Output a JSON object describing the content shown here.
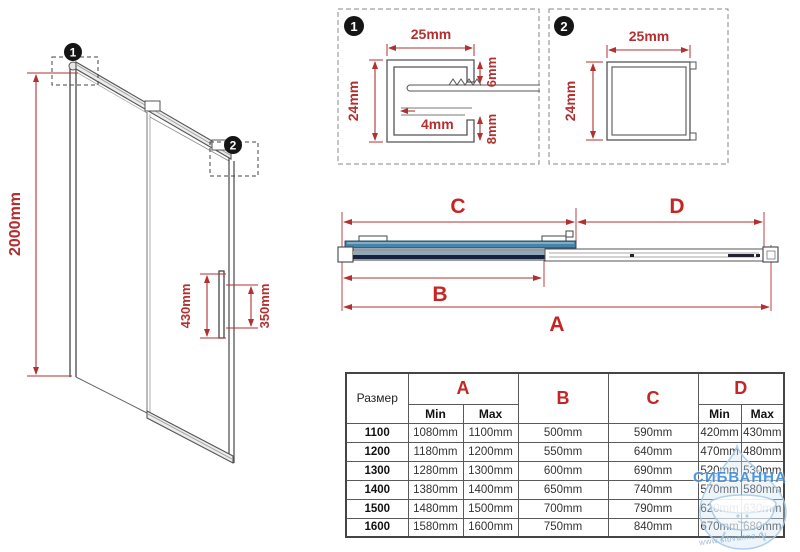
{
  "colors": {
    "dimension_red": "#b23030",
    "header_red": "#c42525",
    "glass_blue": "#4585ac",
    "profile_navy": "#16233f",
    "line_gray": "#555555",
    "watermark_blue": "#3f8cd6",
    "watermark_light": "#a9cae6"
  },
  "left_view": {
    "height_dim": "2000mm",
    "handle_dim_left": "430mm",
    "handle_dim_right": "350mm",
    "marker1": "1",
    "marker2": "2"
  },
  "detail1": {
    "badge": "1",
    "width_dim": "25mm",
    "height_dim": "24mm",
    "inner_dim": "4mm",
    "upper_dim": "6mm",
    "lower_dim": "8mm"
  },
  "detail2": {
    "badge": "2",
    "width_dim": "25mm",
    "height_dim": "24mm"
  },
  "section": {
    "dim_a": "A",
    "dim_b": "B",
    "dim_c": "C",
    "dim_d": "D"
  },
  "table": {
    "size_header": "Размер",
    "col_a": "A",
    "col_b": "B",
    "col_c": "C",
    "col_d": "D",
    "min": "Min",
    "max": "Max",
    "rows": [
      {
        "size": "1100",
        "a_min": "1080mm",
        "a_max": "1100mm",
        "b": "500mm",
        "c": "590mm",
        "d_min": "420mm",
        "d_max": "430mm"
      },
      {
        "size": "1200",
        "a_min": "1180mm",
        "a_max": "1200mm",
        "b": "550mm",
        "c": "640mm",
        "d_min": "470mm",
        "d_max": "480mm"
      },
      {
        "size": "1300",
        "a_min": "1280mm",
        "a_max": "1300mm",
        "b": "600mm",
        "c": "690mm",
        "d_min": "520mm",
        "d_max": "530mm"
      },
      {
        "size": "1400",
        "a_min": "1380mm",
        "a_max": "1400mm",
        "b": "650mm",
        "c": "740mm",
        "d_min": "570mm",
        "d_max": "580mm"
      },
      {
        "size": "1500",
        "a_min": "1480mm",
        "a_max": "1500mm",
        "b": "700mm",
        "c": "790mm",
        "d_min": "620mm",
        "d_max": "630mm"
      },
      {
        "size": "1600",
        "a_min": "1580mm",
        "a_max": "1600mm",
        "b": "750mm",
        "c": "840mm",
        "d_min": "670mm",
        "d_max": "680mm"
      }
    ]
  },
  "watermark": {
    "name": "СИБВАННА",
    "site": "www.sibvanna.ru"
  }
}
